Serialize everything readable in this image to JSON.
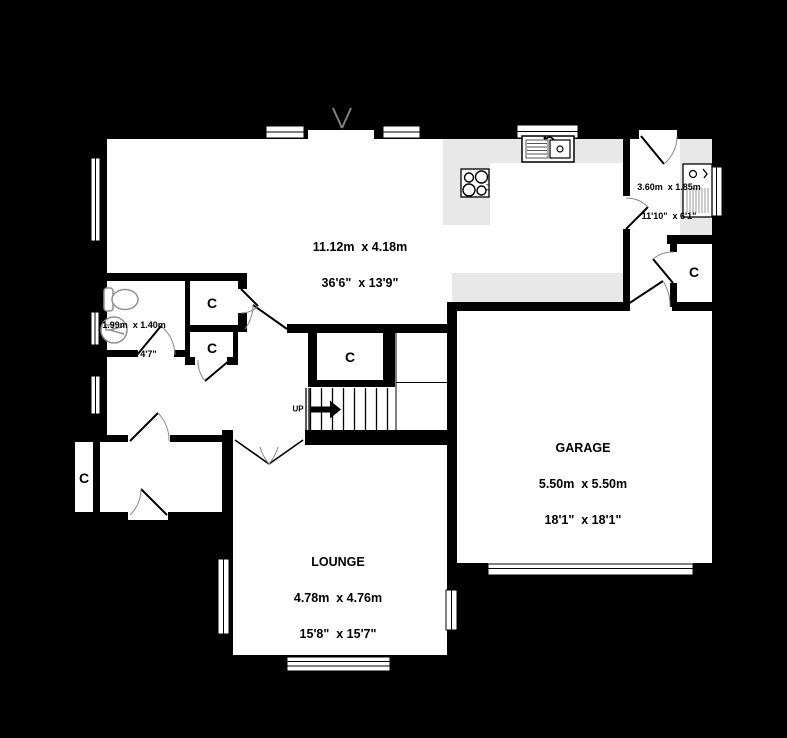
{
  "floorplan": {
    "colors": {
      "background": "#000000",
      "wall": "#000000",
      "floor": "#ffffff",
      "counter": "#e8e8e8",
      "door_arc": "#888888"
    },
    "rooms": {
      "kitchen_living": {
        "size_metric": "11.12m  x 4.18m",
        "size_imperial": "36'6\"  x 13'9\""
      },
      "utility": {
        "size_metric": "3.60m  x 1.85m",
        "size_imperial": "11'10\"  x 6'1\""
      },
      "wc": {
        "size_metric": "1.99m  x 1.40m",
        "size_imperial": "6'6\"  x 4'7\""
      },
      "garage": {
        "name": "GARAGE",
        "size_metric": "5.50m  x 5.50m",
        "size_imperial": "18'1\"  x 18'1\""
      },
      "lounge": {
        "name": "LOUNGE",
        "size_metric": "4.78m  x 4.76m",
        "size_imperial": "15'8\"  x 15'7\""
      }
    },
    "labels": {
      "closet": "C",
      "up": "UP"
    }
  }
}
